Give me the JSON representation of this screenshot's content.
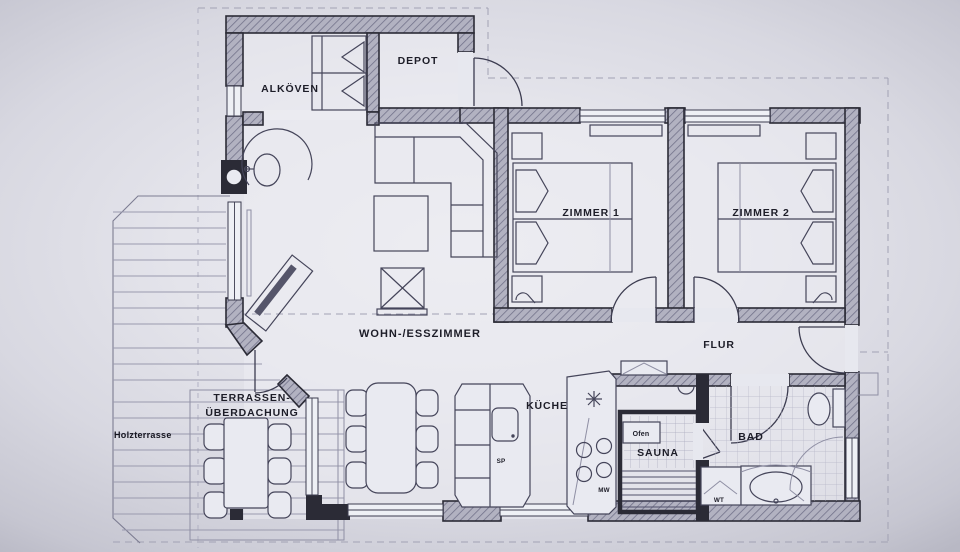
{
  "floorplan": {
    "title": "Apartment floor plan",
    "rooms": {
      "alkoven": "ALKÖVEN",
      "depot": "DEPOT",
      "zimmer1": "ZIMMER 1",
      "zimmer2": "ZIMMER 2",
      "wohn": "WOHN-/ESSZIMMER",
      "flur": "FLUR",
      "kueche": "KÜCHE",
      "sauna": "SAUNA",
      "bad": "BAD"
    },
    "outdoor": {
      "terrasse1": "TERRASSEN-",
      "terrasse2": "ÜBERDACHUNG",
      "holzterrasse": "Holzterrasse"
    },
    "fixtures": {
      "ofen": "Ofen",
      "wt": "WT",
      "sp": "SP",
      "mw": "MW"
    },
    "colors": {
      "paper": "#e4e4eb",
      "wall": "#2b2b36",
      "wall_fill": "#b2b2c1",
      "line": "#45455a",
      "text": "#1d1d28"
    }
  }
}
